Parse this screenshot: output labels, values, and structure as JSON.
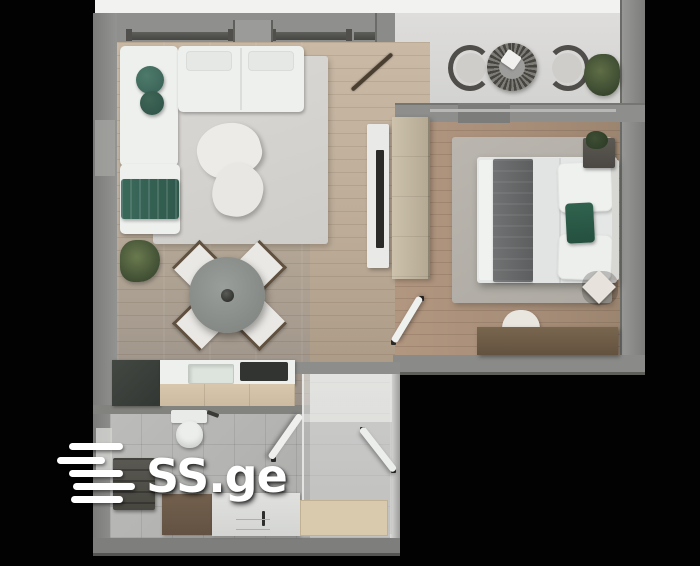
{
  "watermark": {
    "text": "SS.ge",
    "icon": "speed-lines-icon",
    "color": "#ffffff"
  },
  "scene": {
    "type": "apartment-floor-plan-3d-render",
    "view": "top-down",
    "rooms": [
      {
        "name": "living-dining-room",
        "items": [
          "corner-sofa",
          "green-cushions",
          "green-throw",
          "area-rug",
          "kidney-coffee-tables",
          "floor-plant",
          "round-dining-table",
          "dining-chairs",
          "tv-panel",
          "coat-rack"
        ]
      },
      {
        "name": "balcony",
        "items": [
          "curved-lounge-chair-left",
          "round-rattan-table",
          "curved-lounge-chair-right",
          "potted-plant"
        ]
      },
      {
        "name": "bedroom",
        "items": [
          "wardrobe",
          "double-bed",
          "gray-blanket",
          "green-pillow",
          "nightstand",
          "bedside-rug",
          "half-round-pouf",
          "foot-bench",
          "diamond-stool",
          "open-door"
        ]
      },
      {
        "name": "kitchen",
        "items": [
          "tall-dark-cabinet",
          "countertop",
          "sink",
          "cooktop"
        ]
      },
      {
        "name": "bathroom",
        "items": [
          "toilet",
          "towel-cabinet",
          "vanity-cabinet",
          "sink-counter",
          "shower-tray",
          "glass-partition",
          "open-door"
        ]
      }
    ]
  },
  "palette": {
    "background": "#000000",
    "walls": "#8d8d8b",
    "wood_floor": "#b9ab99",
    "bedroom_floor": "#a78e79",
    "balcony_floor": "#dadad8",
    "tile_floor": "#b5b5b3",
    "sofa_white": "#eef0ee",
    "accent_green": "#3c6a5c",
    "cabinet_tan": "#d4c3a8",
    "furniture_brown": "#6e5c4b",
    "dark_unit": "#3b403c"
  }
}
